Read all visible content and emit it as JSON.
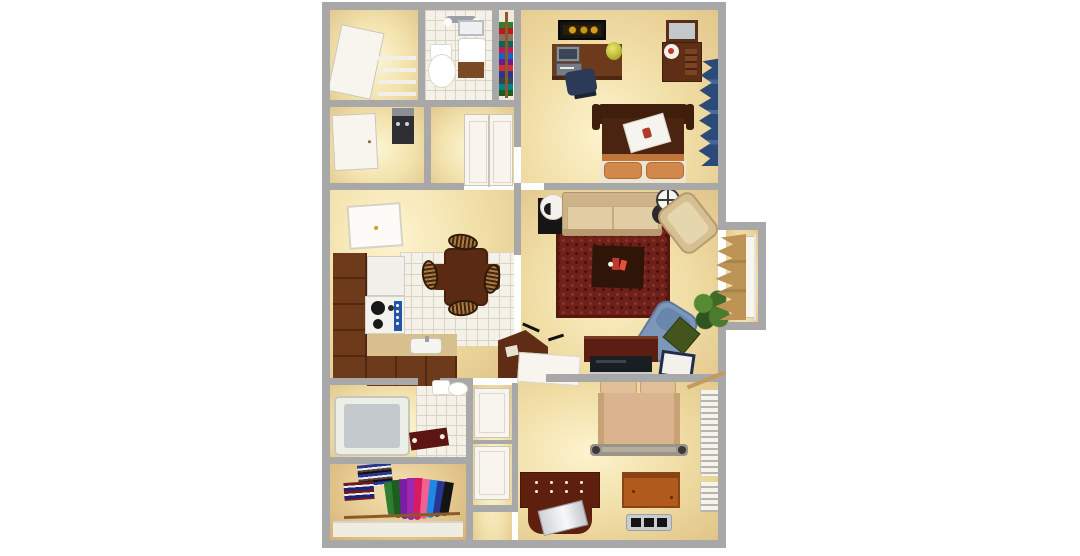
{
  "meta": {
    "description": "3D top-down rendering of a one/two-bedroom apartment floor plan with furniture",
    "background": "#ffffff"
  },
  "palette": {
    "wall_gray": "#a8a8a8",
    "floor_tan": "#e7d0a0",
    "floor_glow": "#fdf6d3",
    "tile": "#f4f1e9",
    "tile_line": "#d9d4c4",
    "cabinet_brown": "#6e3a1c",
    "dark_wood": "#4a2410",
    "maroon_wood": "#5e1f0f",
    "rug_red": "#6e211b",
    "sofa_tan": "#d9c59c",
    "bed1_orange": "#d2884a",
    "bed2_peach": "#d9b48e",
    "recliner_blue": "#7d97bb",
    "pillow_green": "#44541d",
    "drape_navy": "#2c4a78",
    "curtain_tan": "#bd9455",
    "plant_green": "#4c7a2e",
    "chest_orange": "#b05a1e",
    "accent_red": "#c0392b"
  },
  "rooms": {
    "storage_closet": {
      "name": "Storage closet",
      "items": [
        "open white door",
        "wire shelving"
      ]
    },
    "bathroom_1": {
      "name": "Bathroom 1",
      "items": [
        "vanity light",
        "toilet",
        "vanity sink with mirror",
        "tile floor"
      ]
    },
    "linen_closet": {
      "name": "Linen closet",
      "items": [
        "stacked folded towels"
      ]
    },
    "bedroom_1": {
      "name": "Bedroom 1",
      "items": [
        "wall art",
        "computer desk",
        "desk lamp",
        "desk chair",
        "dresser with mirror",
        "bed with breakfast tray",
        "navy window drapes"
      ]
    },
    "hallway": {
      "name": "Hallway",
      "items": [
        "hall door",
        "utility unit",
        "double-door closet"
      ]
    },
    "dining_area": {
      "name": "Dining area",
      "items": [
        "wall frame",
        "dining table",
        "four woven chairs"
      ]
    },
    "kitchen": {
      "name": "Kitchen",
      "items": [
        "L-shaped cabinets",
        "refrigerator",
        "range with blue panel",
        "counter with sink",
        "corner desk",
        "breakfast bar"
      ]
    },
    "living_room": {
      "name": "Living room",
      "items": [
        "end table with lamp",
        "sofa",
        "floor lamp",
        "armchair",
        "patterned area rug",
        "coffee table with red decor",
        "potted plant",
        "recliner with green pillow",
        "tv console with television",
        "tablet tray"
      ]
    },
    "entry": {
      "name": "Entry alcove",
      "items": [
        "front door",
        "tan swag curtains"
      ]
    },
    "bathroom_2": {
      "name": "Bathroom 2",
      "items": [
        "bathtub",
        "bath mat",
        "toilet",
        "door"
      ]
    },
    "walk_in_closet": {
      "name": "Walk-in closet",
      "items": [
        "folded clothes stacks",
        "hanging clothes",
        "closet rod"
      ]
    },
    "hall_closets": {
      "name": "Hall closets",
      "items": [
        "white closet doors"
      ]
    },
    "bedroom_2": {
      "name": "Bedroom 2",
      "items": [
        "bed with peach bedding",
        "dresser with silver runner",
        "wooden chest",
        "floor vent",
        "white window shutters"
      ]
    }
  }
}
